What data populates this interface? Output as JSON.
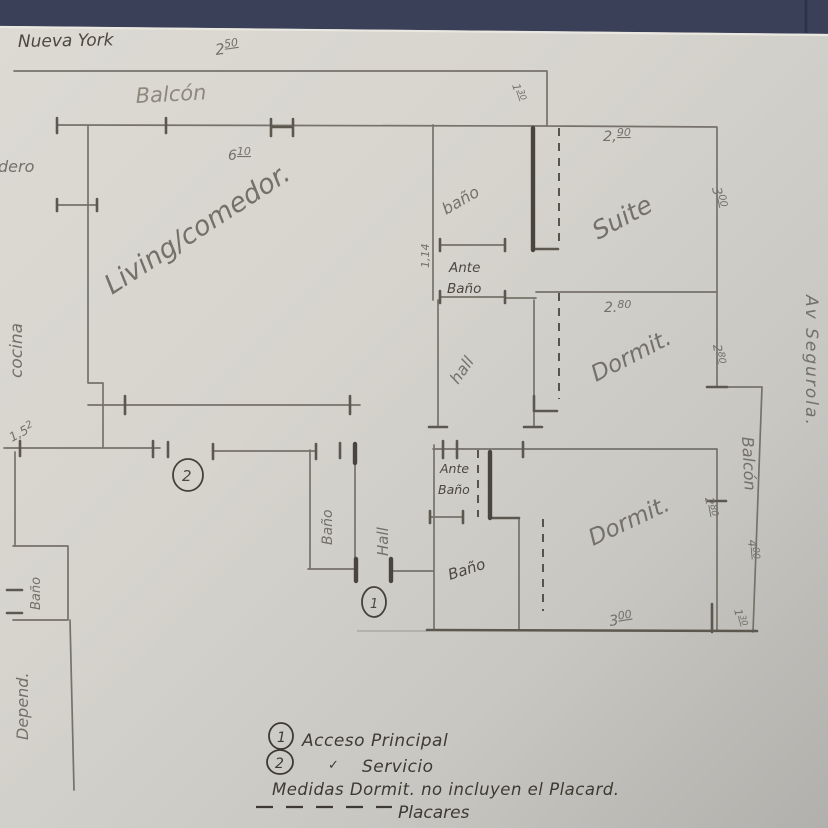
{
  "streets": {
    "top": "Nueva York",
    "right": "Av Segurola."
  },
  "rooms": {
    "balcony_top": "Balcón",
    "living": "Living/comedor.",
    "lavadero": "Lavadero",
    "cocina": "cocina",
    "bath_top": "baño",
    "antebath_top_1": "Ante",
    "antebath_top_2": "Baño",
    "suite": "Suite",
    "hall_top": "hall",
    "dormit_top": "Dormit.",
    "balcony_right": "Balcón",
    "dormit_bottom": "Dormit.",
    "bath_mid": "Baño",
    "hall_bottom": "Hall",
    "antebath_low_1": "Ante",
    "antebath_low_2": "Baño",
    "bath_low": "Baño",
    "bath_service": "Baño",
    "depend": "Depend."
  },
  "measurements": {
    "balcony_top_width": {
      "main": "2",
      "sup": "50"
    },
    "step_top": {
      "main": "1",
      "sup": "30"
    },
    "suite_width": {
      "main": "2,",
      "sup": "90"
    },
    "suite_depth": {
      "main": "3",
      "sup": "00"
    },
    "living_width": {
      "main": "6",
      "sup": "10"
    },
    "antebath_width": {
      "main": "1,14",
      "sup": ""
    },
    "dormit_top_width": {
      "main": "2.",
      "sup": "80"
    },
    "dormit_top_depth": {
      "main": "2",
      "sup": "80"
    },
    "dormit_bottom_depth": {
      "main": "2",
      "sup": "80"
    },
    "balcony_right_length": {
      "main": "4",
      "sup": "00"
    },
    "dormit_bottom_width": {
      "main": "3",
      "sup": "00"
    },
    "balcony_right_width": {
      "main": "1",
      "sup": "30"
    },
    "service_width": {
      "main": "1,5",
      "sup": "2"
    }
  },
  "markers": {
    "main_access": "1",
    "service": "2"
  },
  "legend": {
    "item1_num": "1",
    "item1_text": "Acceso Principal",
    "item2_num": "2",
    "item2_check": "✓",
    "item2_text": "Servicio",
    "note": "Medidas Dormit. no incluyen el Placard.",
    "dash_label": "Placares"
  },
  "colors": {
    "background_navy": "#3a4057",
    "paper": "#d6d4cd",
    "pencil": "#74706a",
    "pencil_dark": "#45413a"
  }
}
